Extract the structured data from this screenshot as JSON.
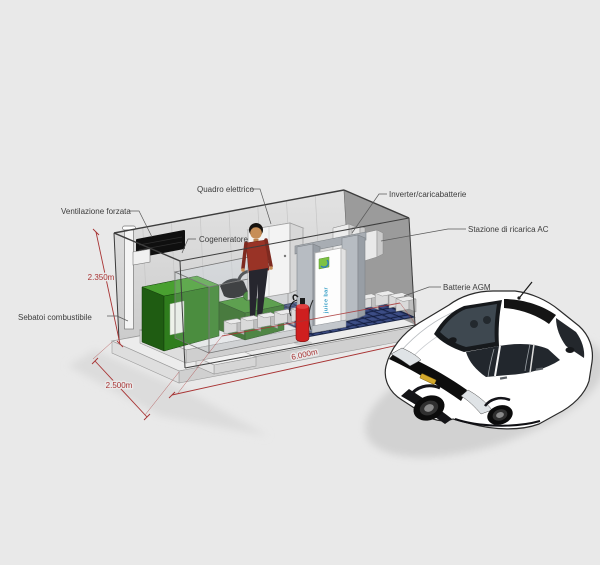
{
  "labels": {
    "ventilazione_forzata": "Ventilazione forzata",
    "quadro_elettrico": "Quadro elettrico",
    "inverter_caricabatterie": "Inverter/caricabatterie",
    "cogeneratore": "Cogeneratore",
    "stazione_ricarica_ac": "Stazione di ricarica AC",
    "batterie_agm": "Batterie AGM",
    "serbatoi_combustibile": "Sebatoi combustibile"
  },
  "dimensions": {
    "height": "2.350m",
    "depth": "2.500m",
    "length": "6.000m"
  },
  "charging_station": {
    "brand": "juice bar"
  },
  "colors": {
    "dimension_red": "#a83434",
    "label_text": "#3c3c3c",
    "cogenerator_green": "#2f7d1d",
    "floor_grating_blue": "#2c3a6a",
    "person_shirt": "#993326",
    "extinguisher_red": "#cf1f1f",
    "station_brand_teal": "#2e9ac4",
    "station_logo_green": "#7dc242",
    "background": "#e9e9e9"
  }
}
